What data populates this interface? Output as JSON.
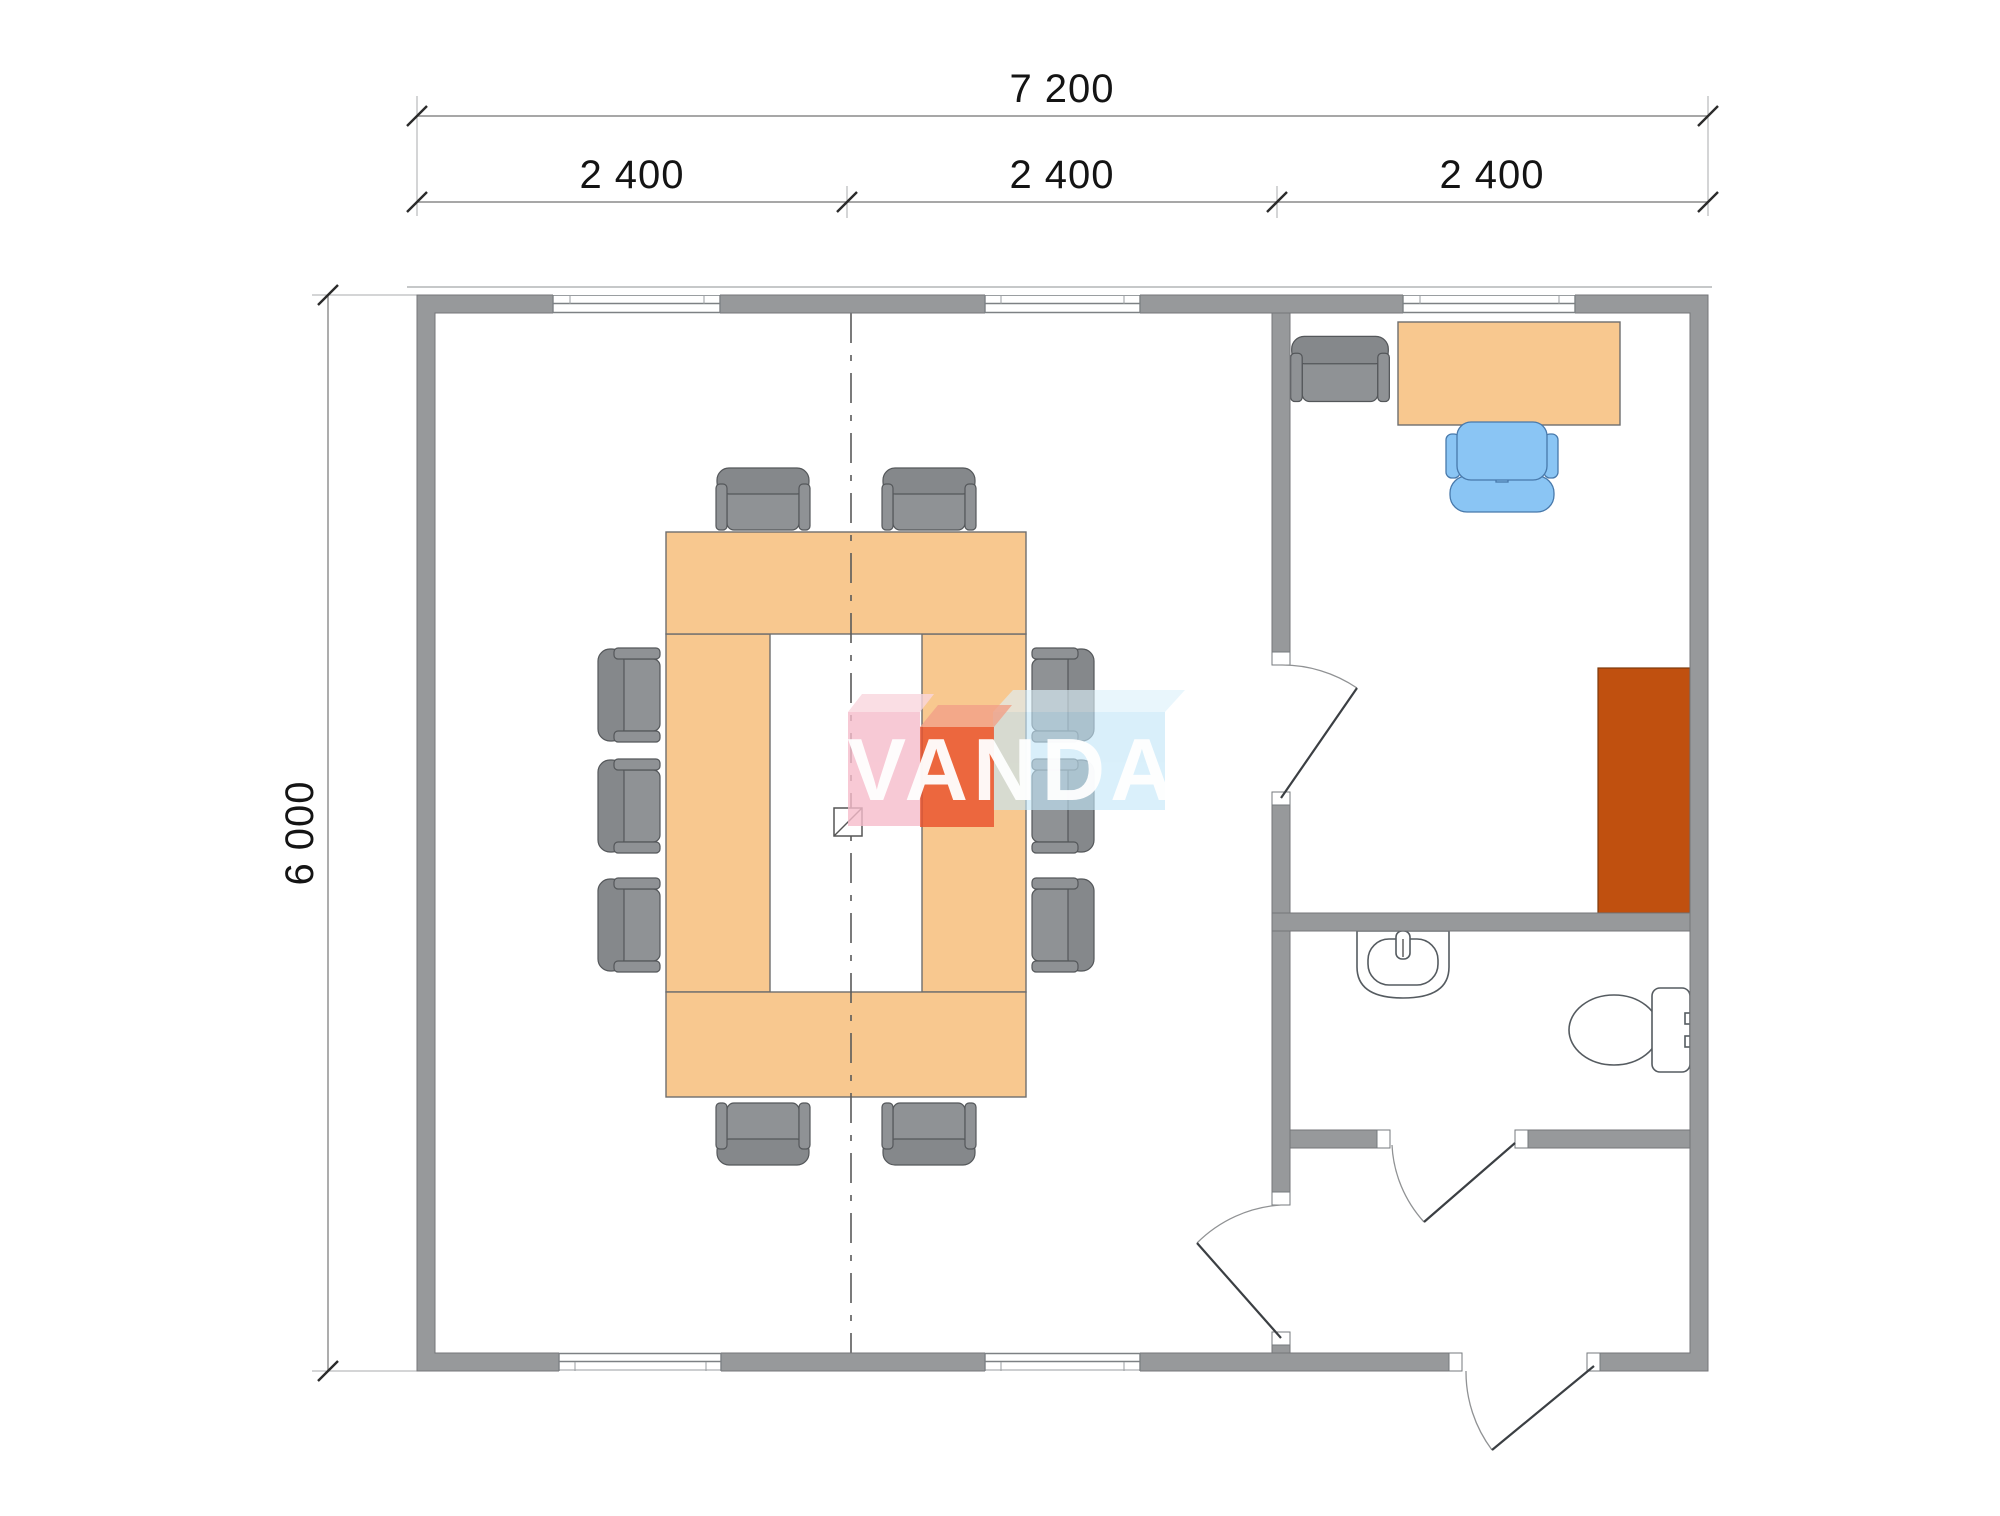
{
  "title": "Floor plan 7 200 x 6 000 modular office",
  "dimensions": {
    "total_width_label": "7 200",
    "bays": [
      "2 400",
      "2 400",
      "2 400"
    ],
    "total_height_label": "6 000"
  },
  "watermark": {
    "text": "VANDA"
  },
  "rooms": {
    "conference": "conference room with U-shaped table, 10 chairs, center column",
    "office": "office with desk, task chair, armchair, cabinet",
    "bathroom": "bathroom with sink and toilet",
    "hall": "entrance hall with exterior door"
  },
  "colors": {
    "wall": "#97999b",
    "wall-edge": "#74767a",
    "furn-orange": "#F8C88F",
    "furn-border": "#6e6e6e",
    "cabinet": "#C0500F",
    "cabinet-border": "#7d3a0c",
    "chair-gray": "#8F9295",
    "chair-gray-dark": "#85888b",
    "chair-border": "#54575a",
    "chair-blue": "#8AC5F4",
    "chair-blue-border": "#4879ab",
    "fixture-stroke": "#555b60",
    "dim-line": "#8a8a8a",
    "dim-text": "#141414",
    "axis": "#5a5a5a",
    "door": "#3b3f43",
    "arc": "#909294",
    "logo-pink-top": "#FAD6DE",
    "logo-pink": "#F6BCCB",
    "logo-red-top": "#F2A188",
    "logo-red": "#EA502B",
    "logo-blue-top": "#DDF1FB",
    "logo-blue": "#C3E6F8",
    "logo-text": "#ffffff"
  }
}
